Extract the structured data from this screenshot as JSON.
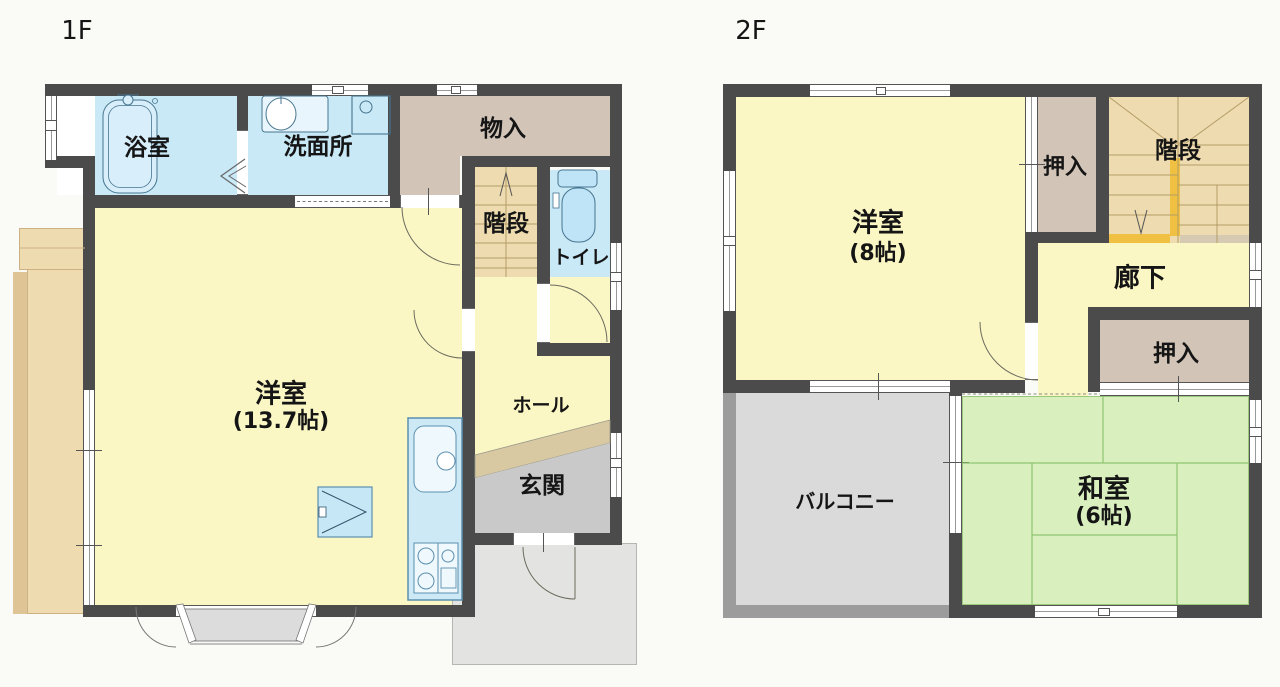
{
  "colors": {
    "bg": "#fafaf7",
    "wall": "#4b4b4b",
    "balcony_wall": "#9c9c9c",
    "room_yellow": "#fbf7c5",
    "wet_blue": "#c9e9f6",
    "closet_tan": "#d2c5b8",
    "stair_beige": "#eedcb0",
    "deck_tan": "#eedcb0",
    "deck_shadow": "#dfc596",
    "tatami_green": "#d9efbe",
    "tatami_line": "#8fc571",
    "entry_gray": "#c9c9c9",
    "step_tan": "#d9c9a2",
    "porch_gray": "#e3e3e1",
    "terrace_gray": "#dcdcdc",
    "balcony_floor": "#dadada",
    "highlight_yellow": "#efc041",
    "stair_shade": "#d6cbb2",
    "fixture_blue": "#d8eefb",
    "fixture_stroke": "#46758f",
    "counter_blue": "#cde9f6",
    "text": "#151515"
  },
  "f1": {
    "floor_label": "1F",
    "bathroom": {
      "label": "浴室"
    },
    "washroom": {
      "label": "洗面所"
    },
    "storage": {
      "label": "物入"
    },
    "stairs": {
      "label": "階段"
    },
    "toilet": {
      "label": "トイレ"
    },
    "living": {
      "label": "洋室",
      "size": "(13.7帖)"
    },
    "hall": {
      "label": "ホール"
    },
    "entrance": {
      "label": "玄関"
    }
  },
  "f2": {
    "floor_label": "2F",
    "western_room": {
      "label": "洋室",
      "size": "(8帖)"
    },
    "closet_top": {
      "label": "押入"
    },
    "stairs": {
      "label": "階段"
    },
    "corridor": {
      "label": "廊下"
    },
    "closet_bottom": {
      "label": "押入"
    },
    "japanese_room": {
      "label": "和室",
      "size": "(6帖)"
    },
    "balcony": {
      "label": "バルコニー"
    }
  }
}
